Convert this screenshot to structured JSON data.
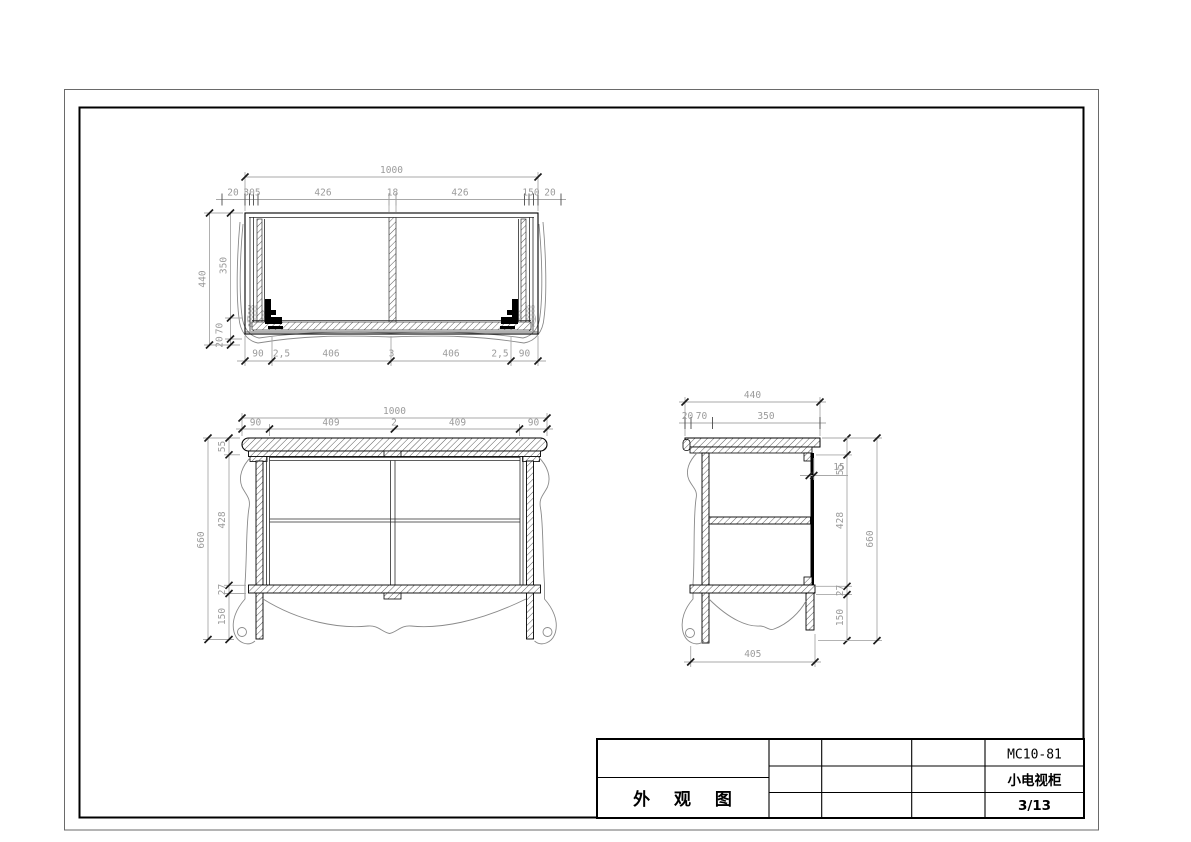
{
  "title_block": {
    "drawing_title": "外 观 图",
    "model_no": "MC10-81",
    "product_name": "小电视柜",
    "sheet_no": "3/13"
  },
  "top_view": {
    "overall_width": "1000",
    "top_chain": [
      "20",
      "305",
      "426",
      "18",
      "426",
      "150",
      "20"
    ],
    "depth_overall": "440",
    "depth_chain": [
      "350",
      "70",
      "20"
    ],
    "bottom_chain": [
      "90",
      "2,5",
      "406",
      "3",
      "406",
      "2,5",
      "90"
    ]
  },
  "front_view": {
    "overall_width": "1000",
    "top_chain": [
      "90",
      "409",
      "2",
      "409",
      "90"
    ],
    "height_overall": "660",
    "height_chain": [
      "55",
      "428",
      "27",
      "150"
    ]
  },
  "side_view": {
    "overall_depth": "440",
    "top_chain": [
      "20",
      "70",
      "350"
    ],
    "back_panel_thickness": "15",
    "bottom_width": "405",
    "height_chain": [
      "55",
      "428",
      "27",
      "150"
    ],
    "height_overall": "660"
  },
  "colors": {
    "line": "#000000",
    "dimension_text": "#9b9b9b",
    "background": "#ffffff"
  }
}
